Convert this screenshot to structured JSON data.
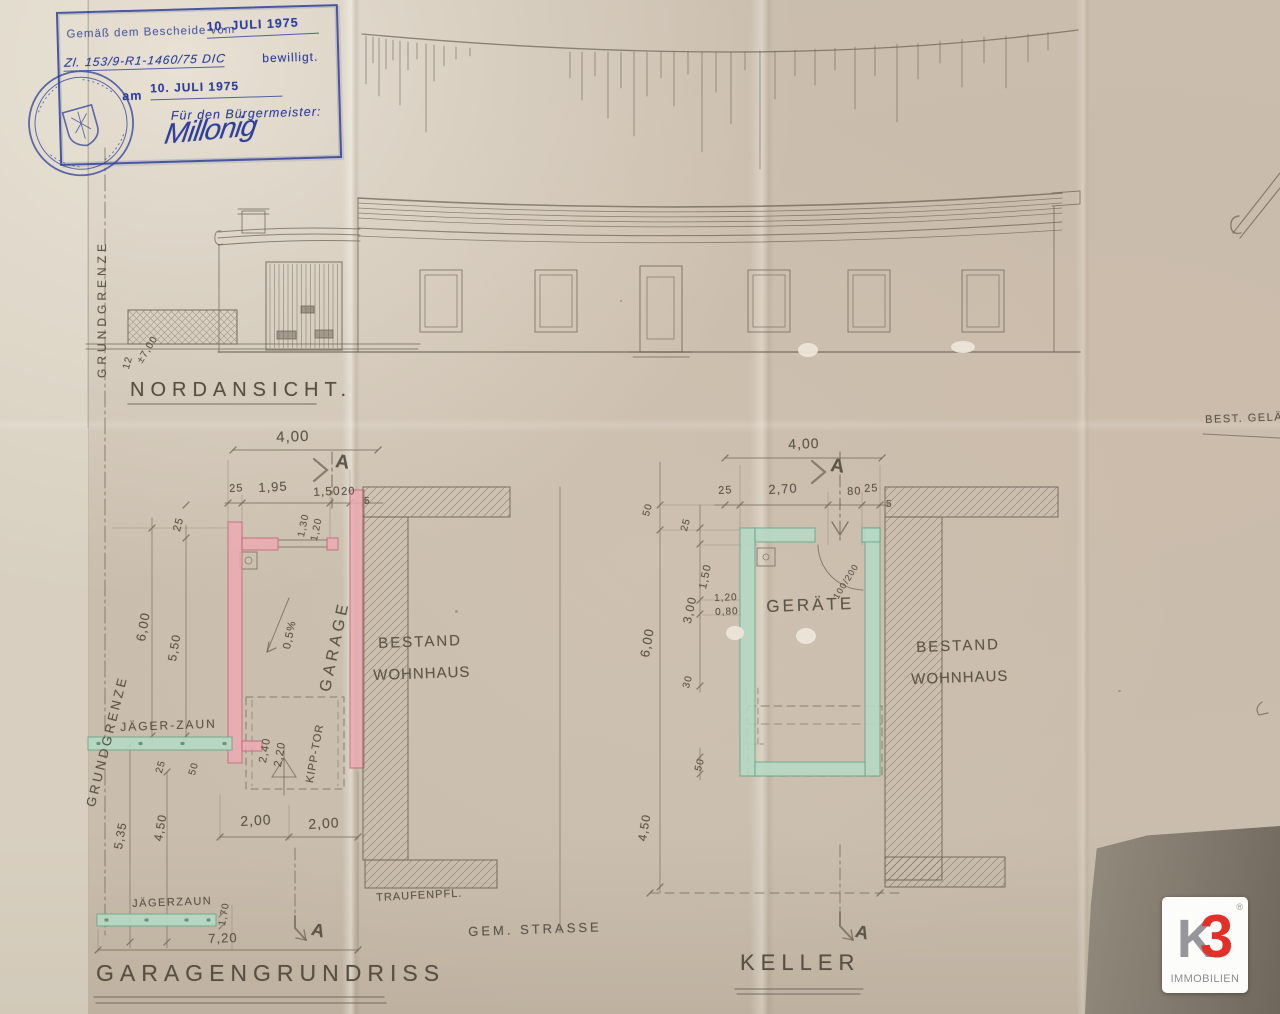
{
  "colors": {
    "pencil": "#6b6355",
    "stamp_blue": "#2f3f9a",
    "wall_pink": "#eda9b3",
    "wall_green": "#b5d9c5",
    "logo_red": "#e23028",
    "logo_gray": "#97969a",
    "paper": "#c9bdad"
  },
  "stamp": {
    "line1_label": "Gemäß dem Bescheide vom",
    "line1_date": "10. JULI 1975",
    "ref_number": "Zl. 153/9-R1-1460/75 DIC",
    "approved_label": "bewilligt.",
    "am_label": "am",
    "am_date": "10. JULI 1975",
    "for_mayor": "Für den Bürgermeister:",
    "signature": "Millonig"
  },
  "elevation": {
    "title": "NORDANSICHT.",
    "boundary_label": "GRUNDGRENZE",
    "ground_note_scale": "12",
    "ground_note_level": "±7,00"
  },
  "notes": {
    "top_right": "BEST. GELÄ"
  },
  "garage": {
    "title": "GARAGENGRUNDRISS",
    "boundary_label": "GRUNDGRENZE",
    "room_label": "GARAGE",
    "slope_label": "0,5%",
    "gate_label": "KIPP-TOR",
    "gate_width": "2,40",
    "gate_height": "2,20",
    "fence_label_top": "JÄGER-ZAUN",
    "fence_label_bottom": "JÄGERZAUN",
    "section_letter": "A",
    "dim_total_width": "4,00",
    "dim_chain": [
      "25",
      "1,95",
      "1,50",
      "20"
    ],
    "dim_wall_small": "5",
    "dim_door_1": "1,30",
    "dim_door_2": "1,20",
    "dim_top_offset": "25",
    "dim_length_outer": "6,00",
    "dim_length_inner": "5,50",
    "dim_fence_offset": "25",
    "dim_fence_gap": "50",
    "dim_left_1": "5,35",
    "dim_left_2": "4,50",
    "dim_half_1": "2,00",
    "dim_half_2": "2,00",
    "dim_fence_height": "1,70",
    "dim_total_bottom": "7,20"
  },
  "keller": {
    "title": "KELLER",
    "room_label": "GERÄTE",
    "door_note": "100/200",
    "section_letter": "A",
    "dim_total_width": "4,00",
    "dim_chain": [
      "25",
      "2,70",
      "80",
      "25"
    ],
    "dim_wall_small": "5",
    "dim_top_1": "50",
    "dim_top_2": "25",
    "dim_side_1": "1,50",
    "dim_side_2": "3,00",
    "dim_door_1": "1,20",
    "dim_door_2": "0,80",
    "dim_length": "6,00",
    "dim_small_30": "30",
    "dim_small_50": "50",
    "dim_bottom": "4,50"
  },
  "neighbor": {
    "line1": "BESTAND",
    "line2": "WOHNHAUS"
  },
  "street": {
    "pavement_label": "TRAUFENPFL.",
    "street_label": "GEM. STRASSE"
  },
  "logo": {
    "letter_k": "K",
    "letter_3": "3",
    "registered": "®",
    "subtitle": "IMMOBILIEN"
  }
}
